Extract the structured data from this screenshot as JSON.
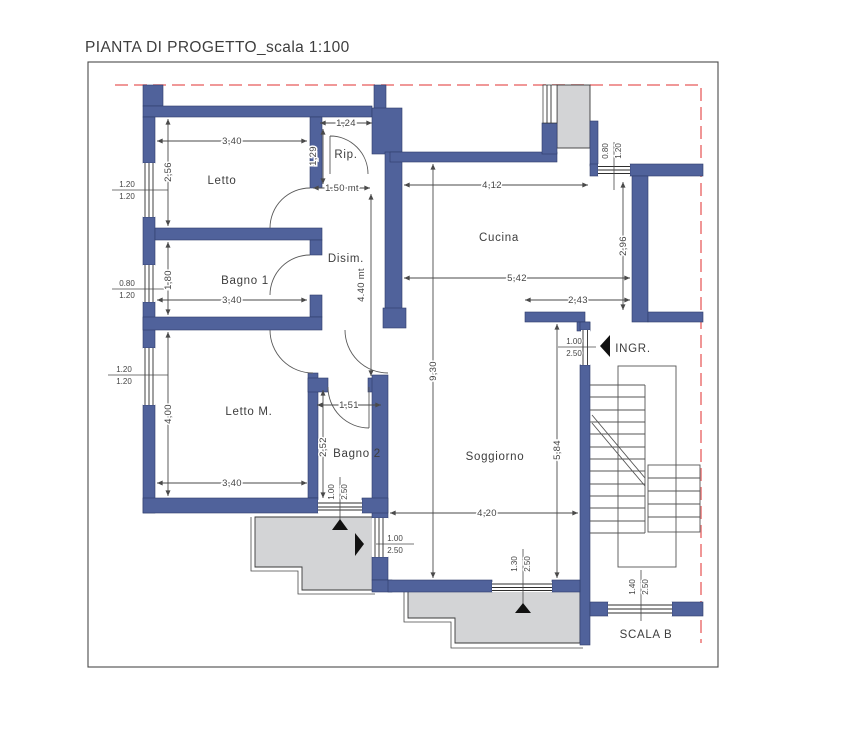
{
  "title": "PIANTA DI PROGETTO_scala 1:100",
  "colors": {
    "wall": "#50629b",
    "balcony": "#d3d4d6",
    "boundary": "#ee8a8a",
    "line": "#4a4a4a"
  },
  "rooms": {
    "letto": "Letto",
    "bagno1": "Bagno 1",
    "rip": "Rip.",
    "disim": "Disim.",
    "cucina": "Cucina",
    "letto_m": "Letto M.",
    "bagno2": "Bagno 2",
    "soggiorno": "Soggiorno",
    "ingresso": "INGR.",
    "scala": "SCALA B"
  },
  "dimensions": {
    "letto_width": "3,40",
    "letto_height": "2,56",
    "rip_width": "1,24",
    "rip_height": "1,29",
    "rip_passage": "1.50 mt",
    "bagno1_width": "3,40",
    "bagno1_height": "1,80",
    "lettom_width": "3,40",
    "lettom_height": "4,00",
    "cucina_top": "4,12",
    "cucina_width": "5,42",
    "cucina_lower": "2,43",
    "cucina_right": "2,96",
    "plan_height": "9,30",
    "disim_height": "4.40 mt",
    "soggiorno_height": "5,84",
    "soggiorno_width": "4,20",
    "bagno2_width": "1,51",
    "bagno2_height": "2,52"
  },
  "openings": {
    "letto_win": {
      "w": "1.20",
      "h": "1.20"
    },
    "bagno1_win": {
      "w": "0.80",
      "h": "1.20"
    },
    "lettom_win": {
      "w": "1.20",
      "h": "1.20"
    },
    "cucina_win": {
      "w": "0.80",
      "h": "1.20"
    },
    "bagno2_win": {
      "w": "1.00",
      "h": "2.50"
    },
    "sogg_west_door": {
      "w": "1.00",
      "h": "2.50"
    },
    "ingresso_door": {
      "w": "1.00",
      "h": "2.50"
    },
    "sogg_south_door": {
      "w": "1.30",
      "h": "2.50"
    },
    "scala_win": {
      "w": "1.40",
      "h": "2.50"
    }
  }
}
